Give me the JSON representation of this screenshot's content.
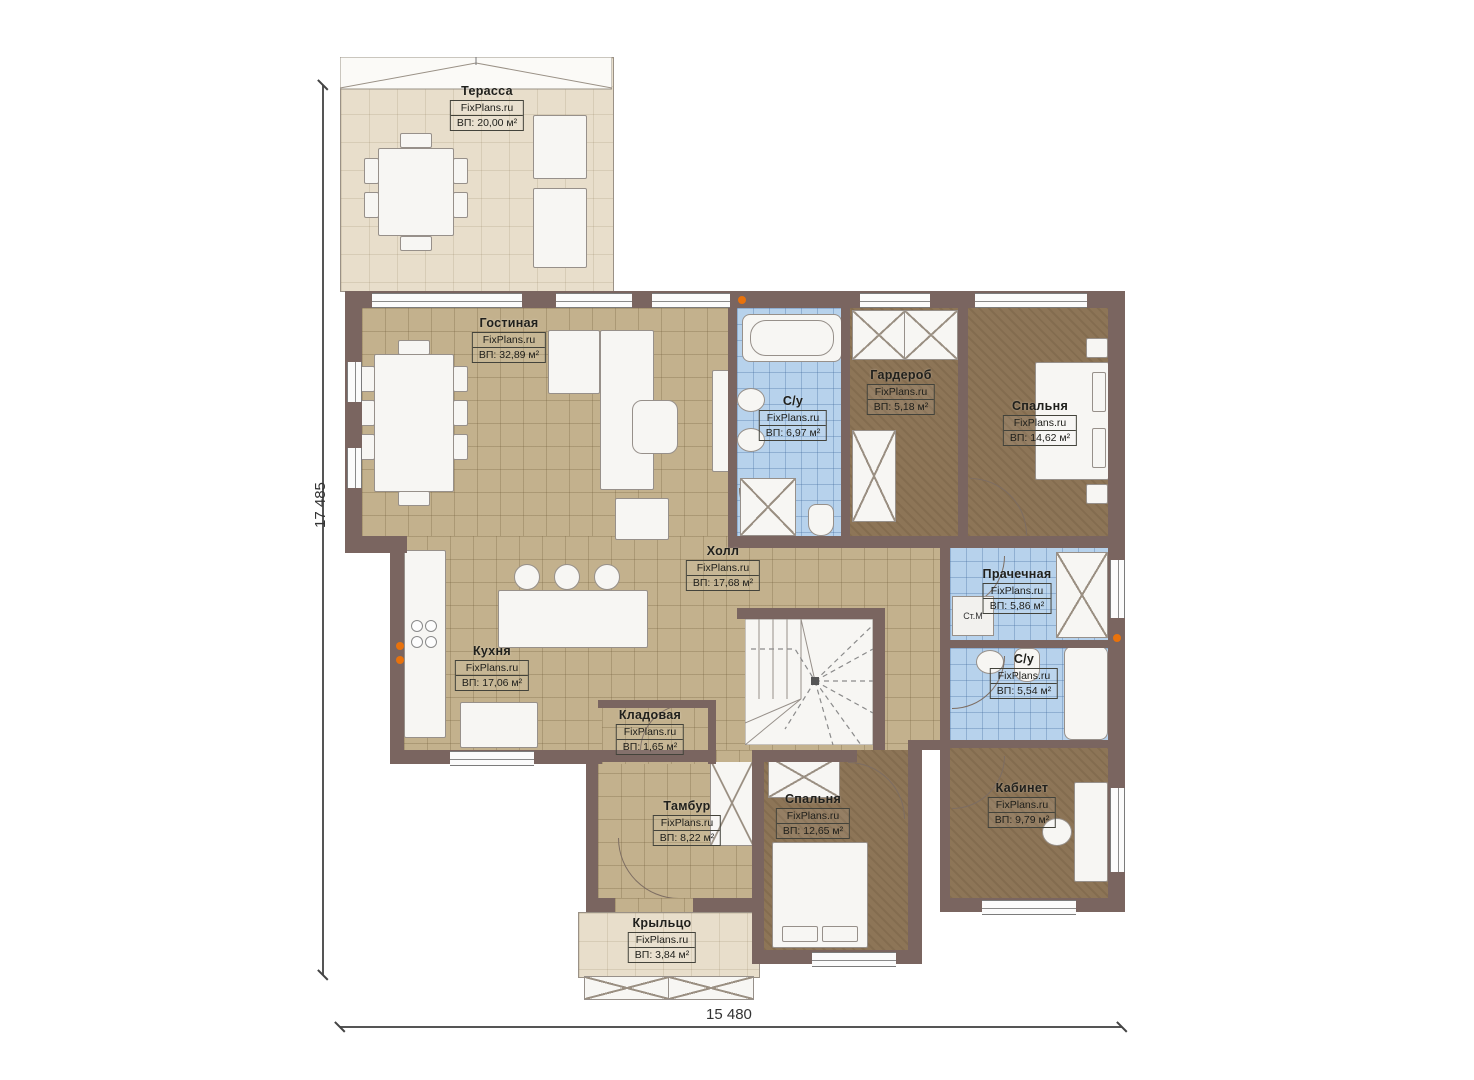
{
  "site": "FixPlans.ru",
  "dimensions": {
    "left": "17 485",
    "bottom": "15 480"
  },
  "labels": {
    "washer": "Ст.М"
  },
  "colors": {
    "wall": "#7a6560",
    "tile_tan": "#c3b18d",
    "floor_brown": "#8d7557",
    "tile_blue": "#b7d2ec",
    "terrace": "#e8decb",
    "accent_socket": "#e8720c"
  },
  "rooms": [
    {
      "name": "Терасса",
      "site": "FixPlans.ru",
      "area": "ВП: 20,00 м²"
    },
    {
      "name": "Гостиная",
      "site": "FixPlans.ru",
      "area": "ВП: 32,89 м²"
    },
    {
      "name": "С/у",
      "site": "FixPlans.ru",
      "area": "ВП: 6,97 м²"
    },
    {
      "name": "Гардероб",
      "site": "FixPlans.ru",
      "area": "ВП: 5,18 м²"
    },
    {
      "name": "Спальня",
      "site": "FixPlans.ru",
      "area": "ВП: 14,62 м²"
    },
    {
      "name": "Холл",
      "site": "FixPlans.ru",
      "area": "ВП: 17,68 м²"
    },
    {
      "name": "Прачечная",
      "site": "FixPlans.ru",
      "area": "ВП: 5,86 м²"
    },
    {
      "name": "Кухня",
      "site": "FixPlans.ru",
      "area": "ВП: 17,06 м²"
    },
    {
      "name": "С/у",
      "site": "FixPlans.ru",
      "area": "ВП: 5,54 м²"
    },
    {
      "name": "Кладовая",
      "site": "FixPlans.ru",
      "area": "ВП: 1,65 м²"
    },
    {
      "name": "Тамбур",
      "site": "FixPlans.ru",
      "area": "ВП: 8,22 м²"
    },
    {
      "name": "Спальня",
      "site": "FixPlans.ru",
      "area": "ВП: 12,65 м²"
    },
    {
      "name": "Кабинет",
      "site": "FixPlans.ru",
      "area": "ВП: 9,79 м²"
    },
    {
      "name": "Крыльцо",
      "site": "FixPlans.ru",
      "area": "ВП: 3,84 м²"
    }
  ]
}
